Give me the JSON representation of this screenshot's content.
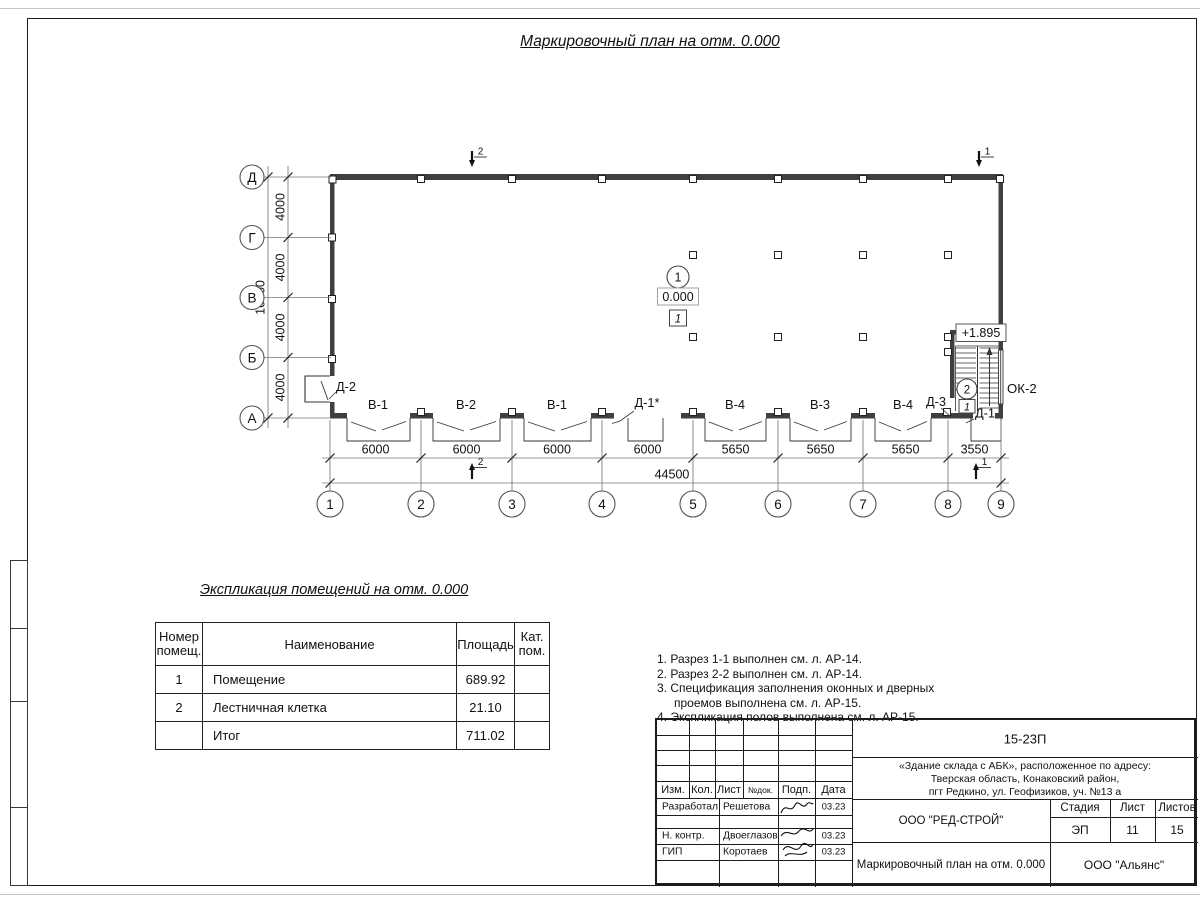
{
  "page": {
    "main_title": "Маркировочный план на отм. 0.000"
  },
  "plan": {
    "vertical_axes": [
      "Д",
      "Г",
      "В",
      "Б",
      "А"
    ],
    "vertical_dims": [
      "4000",
      "4000",
      "4000",
      "4000"
    ],
    "vertical_total": "16000",
    "column_axes": [
      "1",
      "2",
      "3",
      "4",
      "5",
      "6",
      "7",
      "8",
      "9"
    ],
    "bottom_dims": [
      "6000",
      "6000",
      "6000",
      "6000",
      "5650",
      "5650",
      "5650",
      "3550"
    ],
    "bottom_total": "44500",
    "bay_labels": [
      "В-1",
      "В-2",
      "В-1",
      "Д-1*",
      "В-4",
      "В-3",
      "В-4"
    ],
    "door_d3": "Д-3",
    "door_d1": "Д-1",
    "door_d2": "Д-2",
    "window_ok2": "ОК-2",
    "room1": {
      "number": "1",
      "elevation": "0.000",
      "floor_mark": "1"
    },
    "stair": {
      "number": "2",
      "elevation": "+1.895",
      "floor_mark": "1"
    },
    "section1": "1",
    "section2": "2"
  },
  "explication": {
    "title": "Экспликация помещений на отм. 0.000",
    "headers": {
      "num": "Номер\nпомещ.",
      "name": "Наименование",
      "area": "Площадь",
      "cat": "Кат.\nпом."
    },
    "rows": [
      {
        "num": "1",
        "name": "Помещение",
        "area": "689.92",
        "cat": ""
      },
      {
        "num": "2",
        "name": "Лестничная клетка",
        "area": "21.10",
        "cat": ""
      },
      {
        "num": "",
        "name": "Итог",
        "area": "711.02",
        "cat": ""
      }
    ]
  },
  "notes": [
    "1. Разрез 1-1 выполнен см. л. АР-14.",
    "2. Разрез 2-2 выполнен см. л. АР-14.",
    "3. Спецификация заполнения оконных и дверных",
    "проемов выполнена см. л. АР-15.",
    "4. Экспликация полов выполнена см. л. АР-15."
  ],
  "titleblock": {
    "doc_number": "15-23П",
    "project": {
      "line1": "«Здание склада с АБК», расположенное по адресу:",
      "line2": "Тверская область, Конаковский район,",
      "line3": "пгт Редкино, ул. Геофизиков, уч. №13 а"
    },
    "cols": {
      "izm": "Изм.",
      "kol": "Кол.",
      "list": "Лист",
      "ndok": "№док.",
      "podp": "Подп.",
      "data": "Дата"
    },
    "org": "ООО \"РЕД-СТРОЙ\"",
    "stage_label": "Стадия",
    "list_label": "Лист",
    "listov_label": "Листов",
    "stage": "ЭП",
    "sheet": "11",
    "sheets": "15",
    "doc_title": "Маркировочный план на отм. 0.000",
    "company": "ООО \"Альянс\"",
    "rows": [
      {
        "role": "Разработал",
        "name": "Решетова",
        "date": "03.23"
      },
      {
        "role": "Н. контр.",
        "name": "Двоеглазов",
        "date": "03.23"
      },
      {
        "role": "ГИП",
        "name": "Коротаев",
        "date": "03.23"
      }
    ]
  }
}
